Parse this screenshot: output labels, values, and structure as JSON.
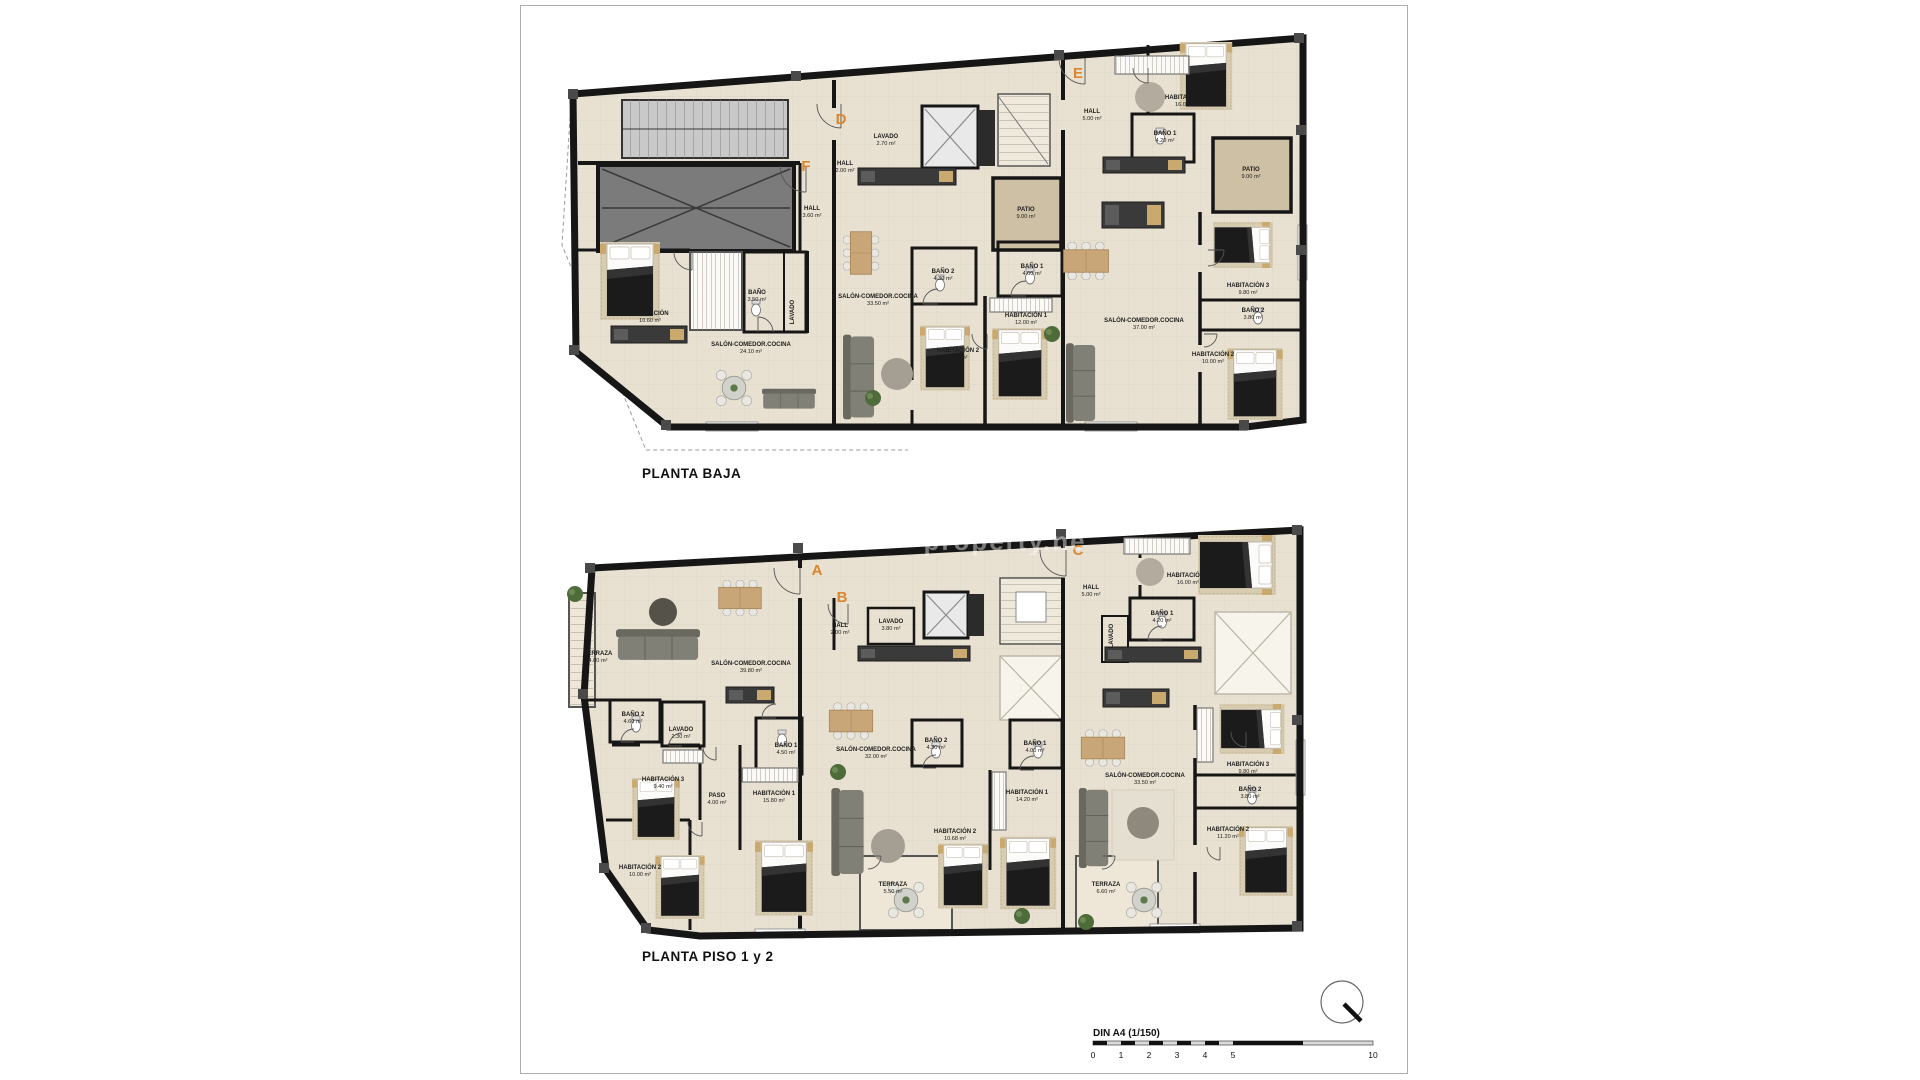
{
  "sheet": {
    "watermark": "property.ne"
  },
  "plans": [
    {
      "id": "planta-baja",
      "title": "PLANTA BAJA",
      "units": [
        {
          "letter": "F",
          "x": 806,
          "y": 171
        },
        {
          "letter": "D",
          "x": 841,
          "y": 124
        },
        {
          "letter": "E",
          "x": 1078,
          "y": 78
        }
      ],
      "rooms": [
        {
          "name": "HALL",
          "area": "2.00 m²",
          "x": 845,
          "y": 165
        },
        {
          "name": "LAVADO",
          "area": "2.70 m²",
          "x": 886,
          "y": 138
        },
        {
          "name": "HALL",
          "area": "3.60 m²",
          "x": 812,
          "y": 210
        },
        {
          "name": "BAÑO",
          "area": "3.50 m²",
          "x": 757,
          "y": 294
        },
        {
          "name": "LAVADO",
          "area": "",
          "x": 794,
          "y": 312,
          "rotate": true
        },
        {
          "name": "HABITACIÓN",
          "area": "10.60 m²",
          "x": 650,
          "y": 315
        },
        {
          "name": "SALÓN-COMEDOR.COCINA",
          "area": "24.10 m²",
          "x": 751,
          "y": 346
        },
        {
          "name": "SALÓN-COMEDOR.COCINA",
          "area": "33.50 m²",
          "x": 878,
          "y": 298
        },
        {
          "name": "PATIO",
          "area": "9.00 m²",
          "x": 1026,
          "y": 211
        },
        {
          "name": "BAÑO 2",
          "area": "4.30 m²",
          "x": 943,
          "y": 273
        },
        {
          "name": "BAÑO 1",
          "area": "4.00 m²",
          "x": 1032,
          "y": 268
        },
        {
          "name": "HABITACIÓN 1",
          "area": "12.00 m²",
          "x": 1026,
          "y": 317
        },
        {
          "name": "HABITACIÓN 2",
          "area": "8.20 m²",
          "x": 958,
          "y": 352
        },
        {
          "name": "HALL",
          "area": "5.00 m²",
          "x": 1092,
          "y": 113
        },
        {
          "name": "HABITACIÓN 1",
          "area": "16.00 m²",
          "x": 1186,
          "y": 99
        },
        {
          "name": "BAÑO 1",
          "area": "4.20 m²",
          "x": 1165,
          "y": 135
        },
        {
          "name": "PATIO",
          "area": "9.00 m²",
          "x": 1251,
          "y": 171
        },
        {
          "name": "SALÓN-COMEDOR.COCINA",
          "area": "37.00 m²",
          "x": 1144,
          "y": 322
        },
        {
          "name": "HABITACIÓN 3",
          "area": "9.80 m²",
          "x": 1248,
          "y": 287
        },
        {
          "name": "BAÑO 2",
          "area": "3.80 m²",
          "x": 1253,
          "y": 312
        },
        {
          "name": "HABITACIÓN 2",
          "area": "10.00 m²",
          "x": 1213,
          "y": 356
        }
      ]
    },
    {
      "id": "planta-piso-1-2",
      "title": "PLANTA PISO 1 y 2",
      "units": [
        {
          "letter": "A",
          "x": 817,
          "y": 575
        },
        {
          "letter": "B",
          "x": 842,
          "y": 602
        },
        {
          "letter": "C",
          "x": 1078,
          "y": 555
        }
      ],
      "rooms": [
        {
          "name": "TERRAZA",
          "area": "4.00 m²",
          "x": 598,
          "y": 655,
          "rotate": false
        },
        {
          "name": "SALÓN-COMEDOR.COCINA",
          "area": "39.80 m²",
          "x": 751,
          "y": 665
        },
        {
          "name": "HALL",
          "area": "2.00 m²",
          "x": 840,
          "y": 627
        },
        {
          "name": "LAVADO",
          "area": "3.80 m²",
          "x": 891,
          "y": 623
        },
        {
          "name": "BAÑO 2",
          "area": "4.60 m²",
          "x": 633,
          "y": 716
        },
        {
          "name": "LAVADO",
          "area": "2.30 m²",
          "x": 681,
          "y": 731
        },
        {
          "name": "BAÑO 1",
          "area": "4.50 m²",
          "x": 786,
          "y": 747
        },
        {
          "name": "HABITACIÓN 3",
          "area": "9.40 m²",
          "x": 663,
          "y": 781
        },
        {
          "name": "PASO",
          "area": "4.00 m²",
          "x": 717,
          "y": 797
        },
        {
          "name": "HABITACIÓN 1",
          "area": "15.80 m²",
          "x": 774,
          "y": 795
        },
        {
          "name": "HABITACIÓN 2",
          "area": "10.00 m²",
          "x": 640,
          "y": 869
        },
        {
          "name": "SALÓN-COMEDOR.COCINA",
          "area": "32.00 m²",
          "x": 876,
          "y": 751
        },
        {
          "name": "BAÑO 2",
          "area": "4.30 m²",
          "x": 936,
          "y": 742
        },
        {
          "name": "HABITACIÓN 2",
          "area": "10.68 m²",
          "x": 955,
          "y": 833
        },
        {
          "name": "TERRAZA",
          "area": "5.50 m²",
          "x": 893,
          "y": 886
        },
        {
          "name": "BAÑO 1",
          "area": "4.00 m²",
          "x": 1035,
          "y": 745
        },
        {
          "name": "HABITACIÓN 1",
          "area": "14.20 m²",
          "x": 1027,
          "y": 794
        },
        {
          "name": "HALL",
          "area": "5.00 m²",
          "x": 1091,
          "y": 589
        },
        {
          "name": "LAVADO",
          "area": "",
          "x": 1113,
          "y": 636,
          "rotate": true
        },
        {
          "name": "HABITACIÓN 1",
          "area": "16.00 m²",
          "x": 1188,
          "y": 577
        },
        {
          "name": "BAÑO 1",
          "area": "4.20 m²",
          "x": 1162,
          "y": 615
        },
        {
          "name": "SALÓN-COMEDOR.COCINA",
          "area": "33.50 m²",
          "x": 1145,
          "y": 777
        },
        {
          "name": "HABITACIÓN 3",
          "area": "9.80 m²",
          "x": 1248,
          "y": 766
        },
        {
          "name": "BAÑO 2",
          "area": "3.80 m²",
          "x": 1250,
          "y": 791
        },
        {
          "name": "HABITACIÓN 2",
          "area": "11.20 m²",
          "x": 1228,
          "y": 831
        },
        {
          "name": "TERRAZA",
          "area": "6.60 m²",
          "x": 1106,
          "y": 886
        }
      ]
    }
  ],
  "scale_bar": {
    "label": "DIN A4 (1/150)",
    "ticks": [
      {
        "v": "0",
        "x": 1093
      },
      {
        "v": "1",
        "x": 1121
      },
      {
        "v": "2",
        "x": 1149
      },
      {
        "v": "3",
        "x": 1177
      },
      {
        "v": "4",
        "x": 1205
      },
      {
        "v": "5",
        "x": 1233
      },
      {
        "v": "10",
        "x": 1373
      }
    ]
  },
  "compass": {
    "name": "north-arrow"
  },
  "colors": {
    "floor": "#e8e1d1",
    "wall": "#161616",
    "patio": "#cdc0a5",
    "ramp": "#7b7b7b",
    "accent": "#d9862e"
  }
}
